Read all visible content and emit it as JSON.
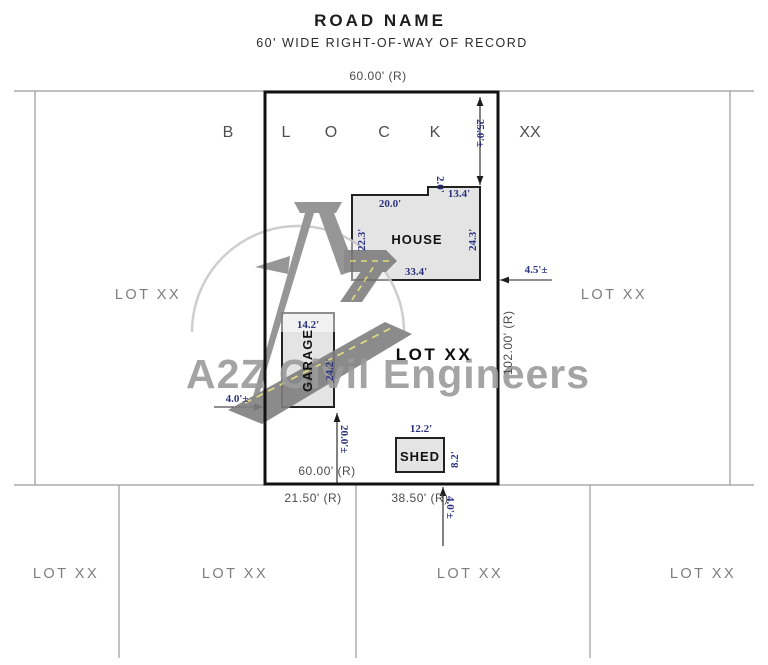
{
  "title": {
    "road_name": "ROAD NAME",
    "row_note": "60' WIDE RIGHT-OF-WAY OF RECORD"
  },
  "block": {
    "letters": [
      "B",
      "L",
      "O",
      "C",
      "K"
    ],
    "number": "XX"
  },
  "lot": {
    "label": "LOT XX"
  },
  "dims": {
    "lot_front": "60.00' (R)",
    "lot_rear": "60.00' (R)",
    "lot_depth": "102.00' (R)",
    "rear_left": "21.50' (R)",
    "rear_right": "38.50' (R)",
    "front_setback": "25.0'±",
    "east_setback": "4.5'±",
    "west_setback": "4.0'±",
    "garage_rear": "20.0'±",
    "shed_rear": "4.0'±"
  },
  "house": {
    "label": "HOUSE",
    "top": "20.0'",
    "notch": "2.0'",
    "top_right": "13.4'",
    "left": "22.3'",
    "right": "24.3'",
    "bottom": "33.4'"
  },
  "garage": {
    "label": "GARAGE",
    "width": "14.2'",
    "depth": "24.2'"
  },
  "shed": {
    "label": "SHED",
    "width": "12.2'",
    "depth": "8.2'"
  },
  "adjacent_lots": {
    "left": "LOT XX",
    "right": "LOT XX",
    "bottom": [
      "LOT XX",
      "LOT XX",
      "LOT XX",
      "LOT XX"
    ]
  },
  "watermark": {
    "text": "A2Z Civil Engineers"
  },
  "colors": {
    "dim_blue": "#2b3280",
    "cad_gray": "#4c4c4c",
    "lot_line": "#111111",
    "building_fill": "#e4e4e4",
    "thin_line": "#9a9a9a",
    "watermark_gray": "#9b9b9b",
    "road_gray": "#7f7f7f",
    "dash_yellow": "#e3dc74"
  }
}
